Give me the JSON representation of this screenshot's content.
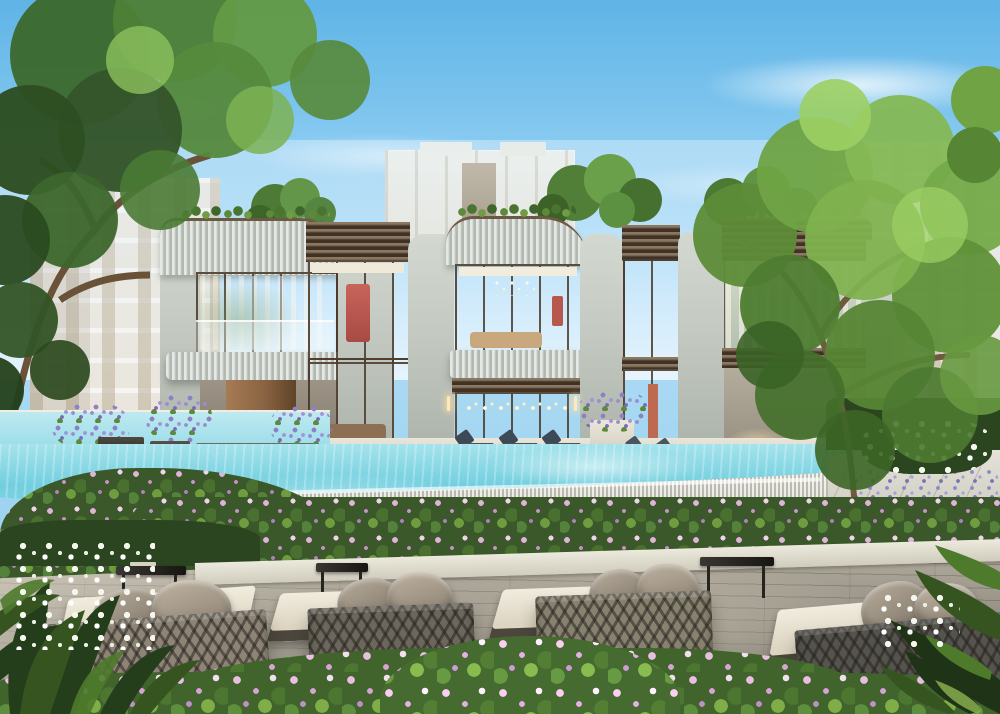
{
  "scene": {
    "type": "architectural_rendering",
    "setting": "Two-storey luxury residence clubhouse with curved ribbed parapets, bronze-framed glazing, infinity-edge swimming pool, flower gardens and a timber sun deck with woven daybeds",
    "sky": "clear daytime sky with thin wispy clouds",
    "visible_text": "none"
  },
  "palette": {
    "sky_top": "#5fb4e6",
    "sky_horizon": "#e8f5fd",
    "pool_water": "#72cfdf",
    "pool_shallow": "#a6e3ec",
    "facade_sage": "#cbd1ca",
    "facade_cream": "#ece5d7",
    "bronze_trim": "#5e4b38",
    "glass_warm_interior": "#dfc9a4",
    "accent_artwork_red": "#bd5a51",
    "foliage_dark": "#2d4e22",
    "foliage_bright": "#8cbf58",
    "flower_pink": "#e2b3da",
    "flower_lavender": "#8f7fc5",
    "flower_white": "#f5f7ef",
    "deck_wood": "#a09a8e",
    "stone_light": "#e6e5dc",
    "rope_taupe": "#8d8476",
    "rope_charcoal": "#55534d",
    "cushion_cream": "#f1ecde",
    "pillow_taupe": "#9c9184"
  },
  "inventory": {
    "clubhouse_storeys": 2,
    "foreground_daybeds": 4,
    "foreground_side_tables": 3,
    "poolside_loungers": 7,
    "lavender_planters": 4,
    "background_apartment_blocks": 3,
    "large_trees": 2
  }
}
